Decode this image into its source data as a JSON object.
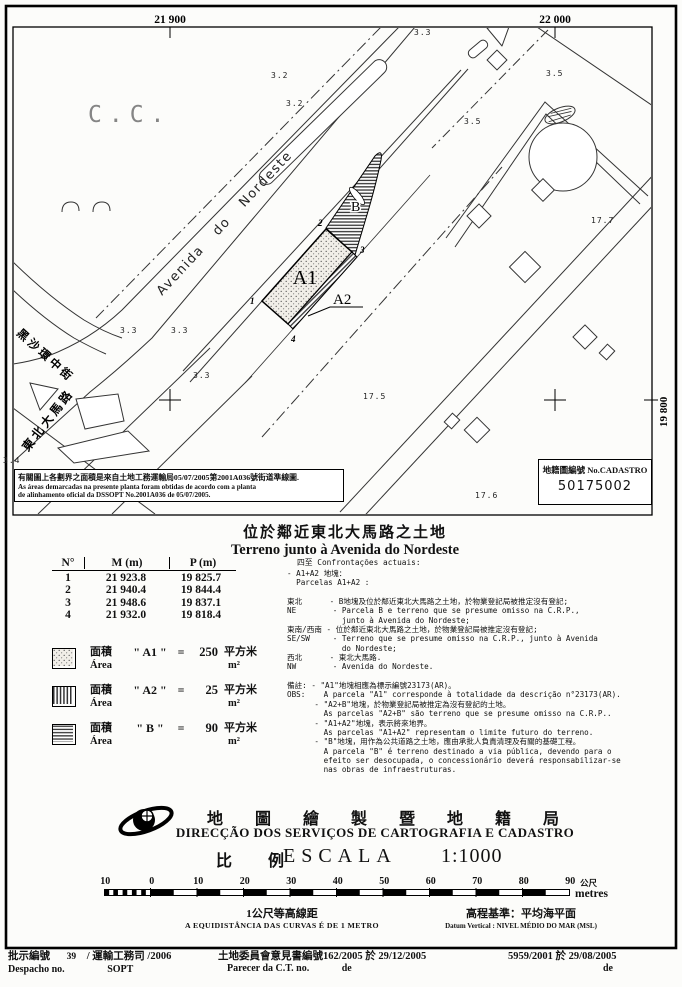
{
  "map": {
    "grid_labels": {
      "top_left": "21 900",
      "top_right": "22 000",
      "right": "19 800"
    },
    "district_label": "C.C.",
    "streets": {
      "avenida": "Avenida   do   Nordeste",
      "heisha": "黑沙環中街",
      "dongbei": "東北大馬路"
    },
    "parcels": {
      "a1": "A1",
      "a2": "A2",
      "b": "B"
    },
    "vertices": [
      "1",
      "2",
      "3",
      "4"
    ],
    "spot_heights": [
      {
        "v": "3.3",
        "x": 414,
        "y": 28
      },
      {
        "v": "3.2",
        "x": 271,
        "y": 71
      },
      {
        "v": "3.2",
        "x": 286,
        "y": 99
      },
      {
        "v": "3.5",
        "x": 546,
        "y": 69
      },
      {
        "v": "3.5",
        "x": 464,
        "y": 117
      },
      {
        "v": "17.7",
        "x": 591,
        "y": 216
      },
      {
        "v": "3.3",
        "x": 120,
        "y": 326
      },
      {
        "v": "3.3",
        "x": 171,
        "y": 326
      },
      {
        "v": "3.3",
        "x": 193,
        "y": 371
      },
      {
        "v": "3.4",
        "x": 3,
        "y": 456
      },
      {
        "v": "17.5",
        "x": 363,
        "y": 392
      },
      {
        "v": "17.6",
        "x": 475,
        "y": 491
      }
    ],
    "note_box": {
      "zh": "有關圖上各劃界之面積是來自土地工務運輸局05/07/2005第2001A036號街道準線圖.",
      "pt1": "As áreas demarcadas na presente planta foram obtidas de acordo com a planta",
      "pt2": "de alinhamento oficial da DSSOPT  No.2001A036 de 05/07/2005."
    },
    "cadastro_box": {
      "label": "地籍圖編號 No.CADASTRO",
      "number": "50175002"
    }
  },
  "title": {
    "zh": "位於鄰近東北大馬路之土地",
    "pt": "Terreno junto à Avenida do Nordeste"
  },
  "coords_table": {
    "headers": [
      "N°",
      "M (m)",
      "P (m)"
    ],
    "rows": [
      [
        "1",
        "21 923.8",
        "19 825.7"
      ],
      [
        "2",
        "21 940.4",
        "19 844.4"
      ],
      [
        "3",
        "21 948.6",
        "19 837.1"
      ],
      [
        "4",
        "21 932.0",
        "19 818.4"
      ]
    ]
  },
  "legend": {
    "items": [
      {
        "zh": "面積",
        "pt": "Área",
        "name": "A1",
        "eq": "=",
        "value": "250",
        "unit_zh": "平方米",
        "unit_pt": "m²"
      },
      {
        "zh": "面積",
        "pt": "Área",
        "name": "A2",
        "eq": "=",
        "value": "25",
        "unit_zh": "平方米",
        "unit_pt": "m²"
      },
      {
        "zh": "面積",
        "pt": "Área",
        "name": "B",
        "eq": "=",
        "value": "90",
        "unit_zh": "平方米",
        "unit_pt": "m²"
      }
    ]
  },
  "confrontations": {
    "header": "四至  Confrontações actuais:",
    "lines": [
      "- A1+A2 地塊：",
      "  Parcelas A1+A2 :",
      "",
      "東北      - B地塊及位於鄰近東北大馬路之土地，於物業登記局被推定沒有登記;",
      "NE        - Parcela B e terreno que se presume omisso na C.R.P.,",
      "            junto à Avenida do Nordeste;",
      "東南/西南 - 位於鄰近東北大馬路之土地，於物業登記局被推定沒有登記;",
      "SE/SW     - Terreno que se presume omisso na C.R.P., junto à Avenida",
      "            do Nordeste;",
      "西北      - 東北大馬路.",
      "NW        - Avenida do Nordeste.",
      "",
      "備註: - \"A1\"地塊相應為標示編號23173(AR)。",
      "OBS:    A parcela \"A1\" corresponde à totalidade da descrição n°23173(AR).",
      "      - \"A2+B\"地塊，於物業登記局被推定為沒有登記的土地。",
      "        As parcelas \"A2+B\" são terreno que se presume omisso na C.R.P..",
      "      - \"A1+A2\"地塊，表示將來地界。",
      "        As parcelas \"A1+A2\" representam o limite futuro do terreno.",
      "      - \"B\"地塊，用作為公共道路之土地，應由承批人負責清理及有關的基礎工程。",
      "        A parcela \"B\" é terreno destinado a via pública, devendo para o",
      "        efeito ser desocupada, o concessionário deverá responsabilizar-se",
      "        nas obras de infraestruturas."
    ]
  },
  "agency": {
    "zh": "地圖繪製暨地籍局",
    "pt": "DIRECÇÃO DOS SERVIÇOS DE CARTOGRAFIA E CADASTRO"
  },
  "scale": {
    "zh": "比 例",
    "label": "ESCALA",
    "ratio": "1:1000",
    "ticks": [
      "10",
      "0",
      "10",
      "20",
      "30",
      "40",
      "50",
      "60",
      "70",
      "80",
      "90"
    ],
    "unit_zh": "公尺",
    "unit_pt": "metres"
  },
  "notes": {
    "contour_zh": "1公尺等高線距",
    "contour_pt": "A EQUIDISTÂNCIA DAS CURVAS É DE 1 METRO",
    "datum_zh": "高程基準：平均海平面",
    "datum_pt": "Datum Vertical : NIVEL MÉDIO DO MAR (MSL)"
  },
  "footer": {
    "despacho_label_zh": "批示編號",
    "despacho_no": "39",
    "despacho_rest": "/ 運輸工務司 /2006",
    "despacho_label_pt": "Despacho no.",
    "despacho_dept_pt": "SOPT",
    "parecer_zh": "土地委員會意見書編號162/2005 於 29/12/2005",
    "parecer_label_pt": "Parecer da C.T. no.",
    "parecer_de": "de",
    "ref": "5959/2001 於 29/08/2005",
    "ref_de": "de"
  }
}
